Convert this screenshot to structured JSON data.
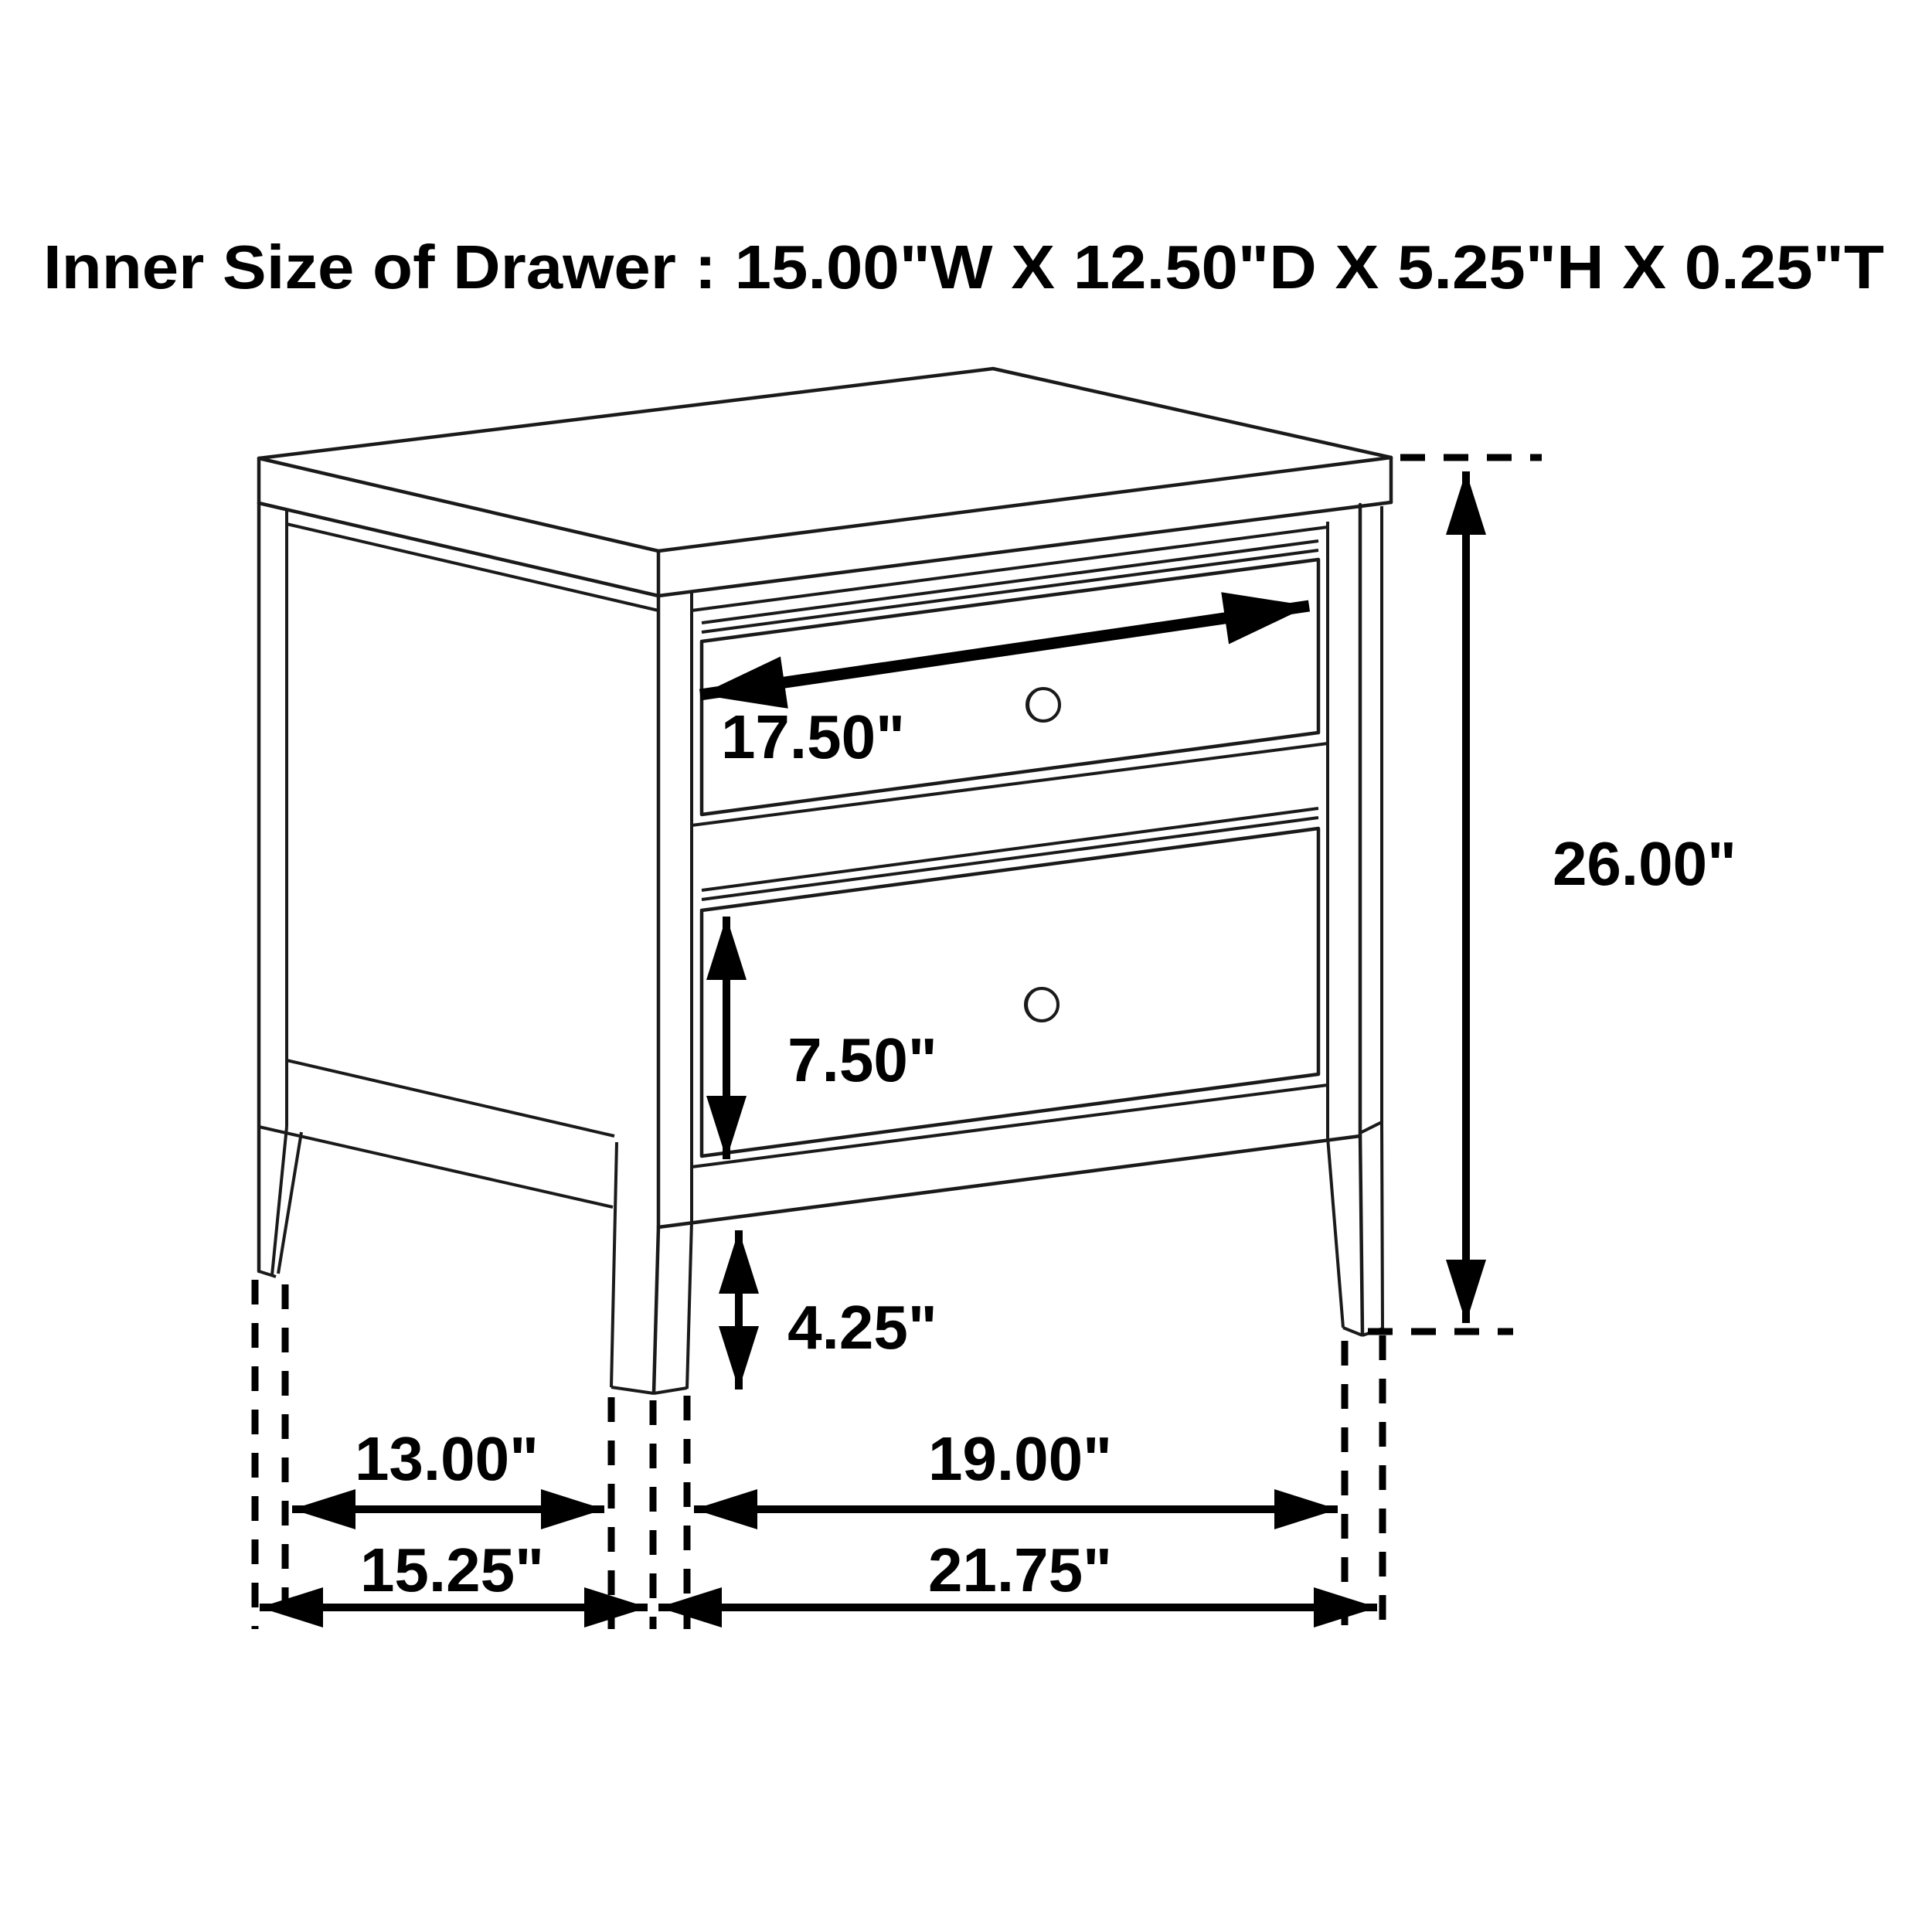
{
  "page": {
    "background": "#ffffff"
  },
  "title": {
    "text": "Inner Size of Drawer : 15.00\"W X 12.50\"D X 5.25\"H X 0.25\"T"
  },
  "diagram": {
    "subject": "two-drawer nightstand dimension line drawing",
    "view": "isometric front-right perspective with dashed projection lines",
    "style": {
      "line_color": "#1a1a1a",
      "annotation_color": "#000000",
      "background": "#ffffff"
    },
    "annotations": {
      "drawer_width": "17.50\"",
      "overall_height": "26.00\"",
      "second_drawer_height": "7.50\"",
      "leg_height": "4.25\"",
      "side_inner_depth": "13.00\"",
      "side_outer_depth": "15.25\"",
      "front_inner_width": "19.00\"",
      "front_outer_width": "21.75\""
    },
    "inner_drawer_size": {
      "width": "15.00\"",
      "depth": "12.50\"",
      "height": "5.25\"",
      "thickness": "0.25\""
    },
    "parts": [
      "top panel",
      "upper drawer",
      "lower drawer",
      "round knobs",
      "tapered legs"
    ]
  }
}
